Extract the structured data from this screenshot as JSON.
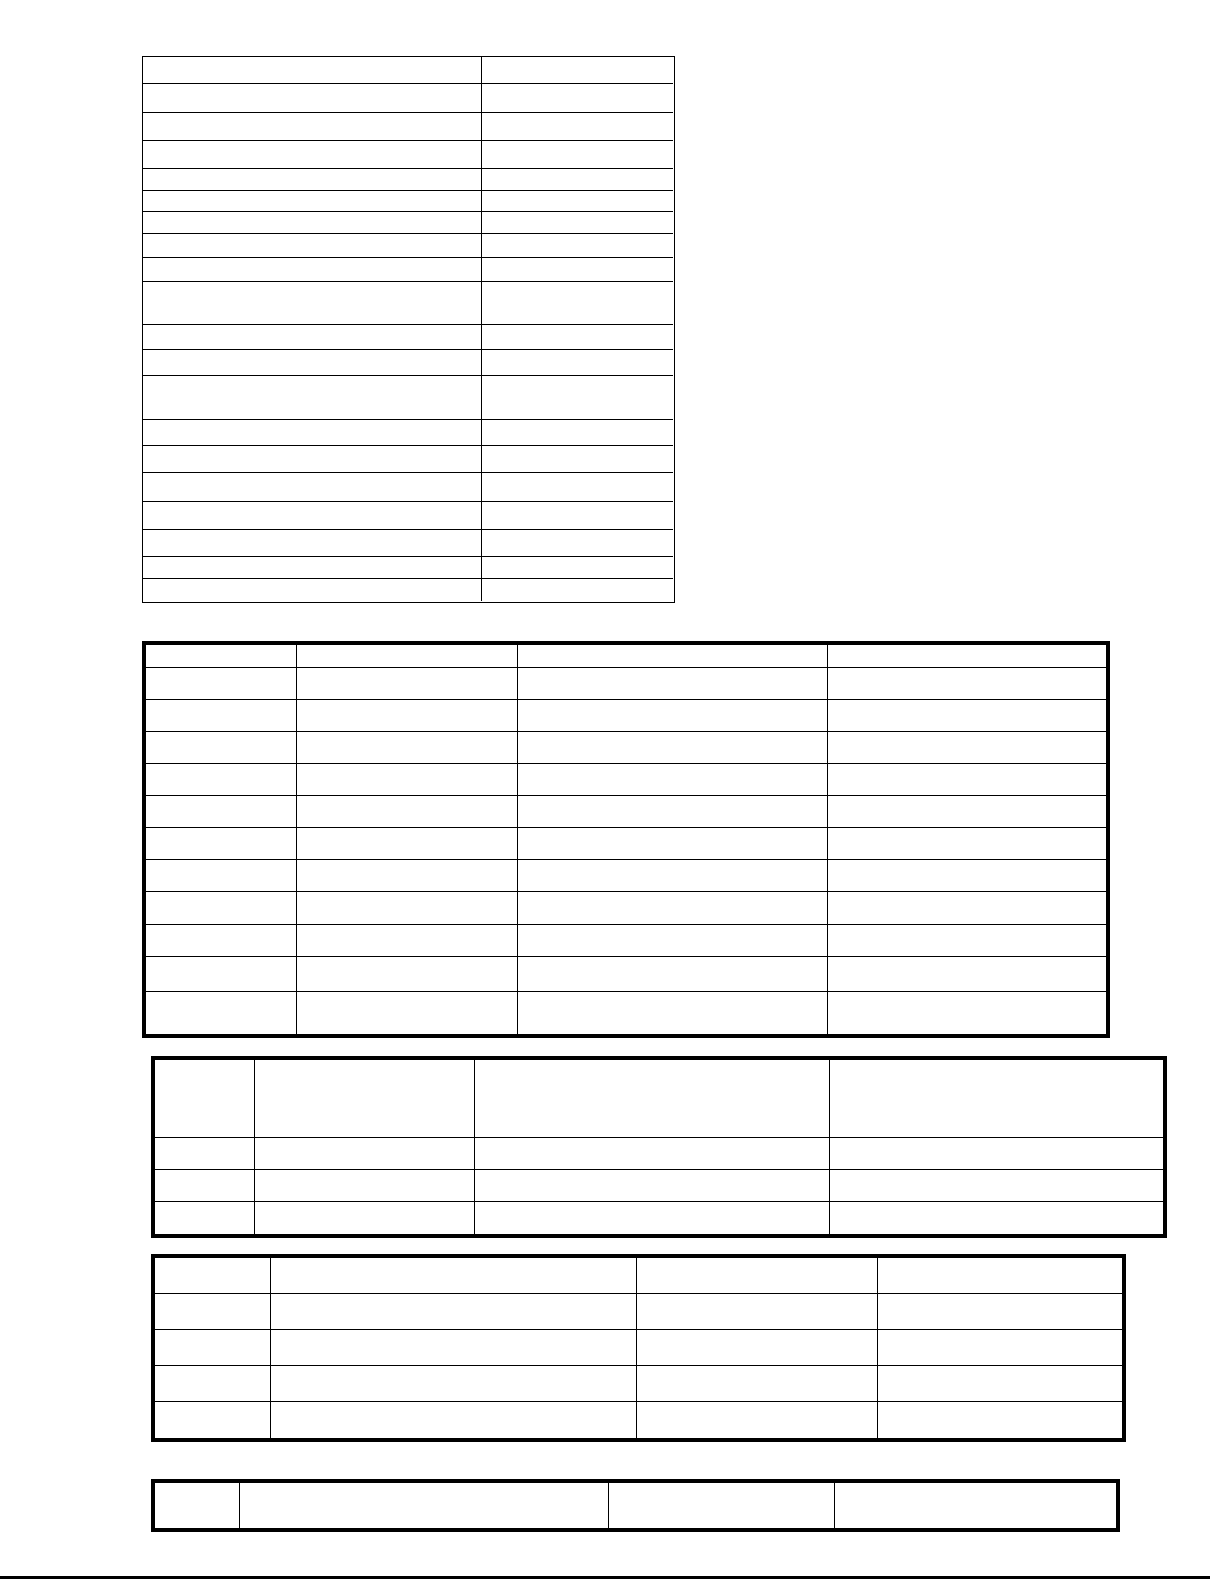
{
  "page": {
    "type": "blank-form-document-page",
    "background": "#ffffff",
    "ink": "#000000",
    "width": 1225,
    "height": 1585,
    "all_cells_empty": true
  },
  "tables": [
    {
      "id": "table-1",
      "description": "two-column-list-table-thin-border",
      "columns": 2,
      "rows": 20,
      "outer_border": 1.5,
      "inner_border": 1.5,
      "col_edges": [
        143,
        482,
        673
      ],
      "row_edges": [
        57,
        84,
        113,
        141,
        169,
        191,
        212,
        234,
        258,
        282,
        325,
        350,
        376,
        420,
        446,
        473,
        502,
        530,
        557,
        579,
        601
      ]
    },
    {
      "id": "table-2",
      "description": "four-column-table-thick-border",
      "columns": 4,
      "rows": 12,
      "outer_border": 4,
      "inner_border": 1.5,
      "col_edges": [
        146,
        297,
        518,
        828,
        1106
      ],
      "row_edges": [
        645,
        668,
        700,
        732,
        764,
        796,
        828,
        860,
        892,
        925,
        957,
        992,
        1034
      ]
    },
    {
      "id": "table-3",
      "description": "four-column-table-tall-header-thick-border",
      "columns": 4,
      "rows": 4,
      "outer_border": 4,
      "inner_border": 1.5,
      "col_edges": [
        155,
        255,
        475,
        830,
        1163
      ],
      "row_edges": [
        1060,
        1138,
        1170,
        1202,
        1234
      ]
    },
    {
      "id": "table-4",
      "description": "four-column-table-thick-border",
      "columns": 4,
      "rows": 5,
      "outer_border": 4,
      "inner_border": 1.5,
      "col_edges": [
        155,
        271,
        637,
        878,
        1122
      ],
      "row_edges": [
        1258,
        1294,
        1330,
        1366,
        1402,
        1438
      ]
    },
    {
      "id": "table-5",
      "description": "four-column-single-row-table-thick-border",
      "columns": 4,
      "rows": 1,
      "outer_border": 4,
      "inner_border": 1.5,
      "col_edges": [
        155,
        240,
        609,
        835,
        1116
      ],
      "row_edges": [
        1483,
        1528
      ]
    }
  ],
  "decorations": {
    "double_underline_blank": {
      "table": "table-1",
      "row": 16,
      "col": 1,
      "x": 288,
      "y": 491,
      "width": 95,
      "style": "double-rule"
    },
    "footer_rule": {
      "x": 0,
      "y": 1576,
      "width": 1210,
      "height": 3
    }
  }
}
